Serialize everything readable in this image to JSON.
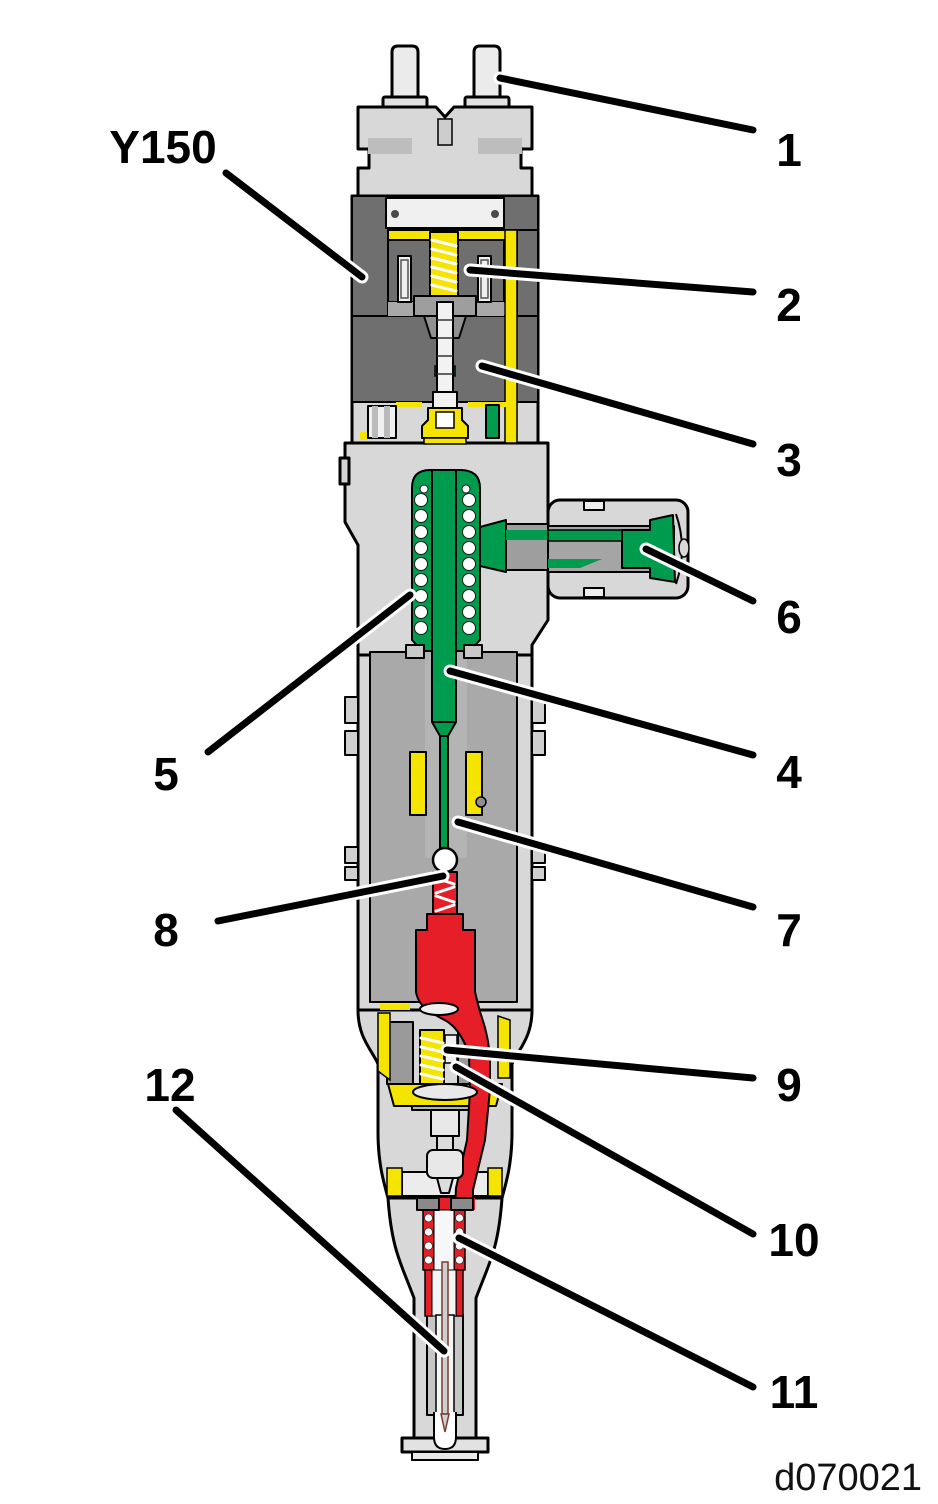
{
  "figure": {
    "device_label": "Y150",
    "drawing_number": "d070021",
    "callouts": [
      {
        "number": "1"
      },
      {
        "number": "2"
      },
      {
        "number": "3"
      },
      {
        "number": "4"
      },
      {
        "number": "5"
      },
      {
        "number": "6"
      },
      {
        "number": "7"
      },
      {
        "number": "8"
      },
      {
        "number": "9"
      },
      {
        "number": "10"
      },
      {
        "number": "11"
      },
      {
        "number": "12"
      }
    ]
  },
  "colors": {
    "background": "#ffffff",
    "outline": "#000000",
    "body_light": "#d8d8d8",
    "body_medium": "#a9a9a9",
    "body_dark": "#6f6f6f",
    "seal_yellow": "#f5e400",
    "fuel_green": "#009b4c",
    "fuel_red": "#e51e28",
    "spring_white": "#ffffff",
    "needle_brown": "#7a3b2e",
    "label_black": "#000000"
  }
}
